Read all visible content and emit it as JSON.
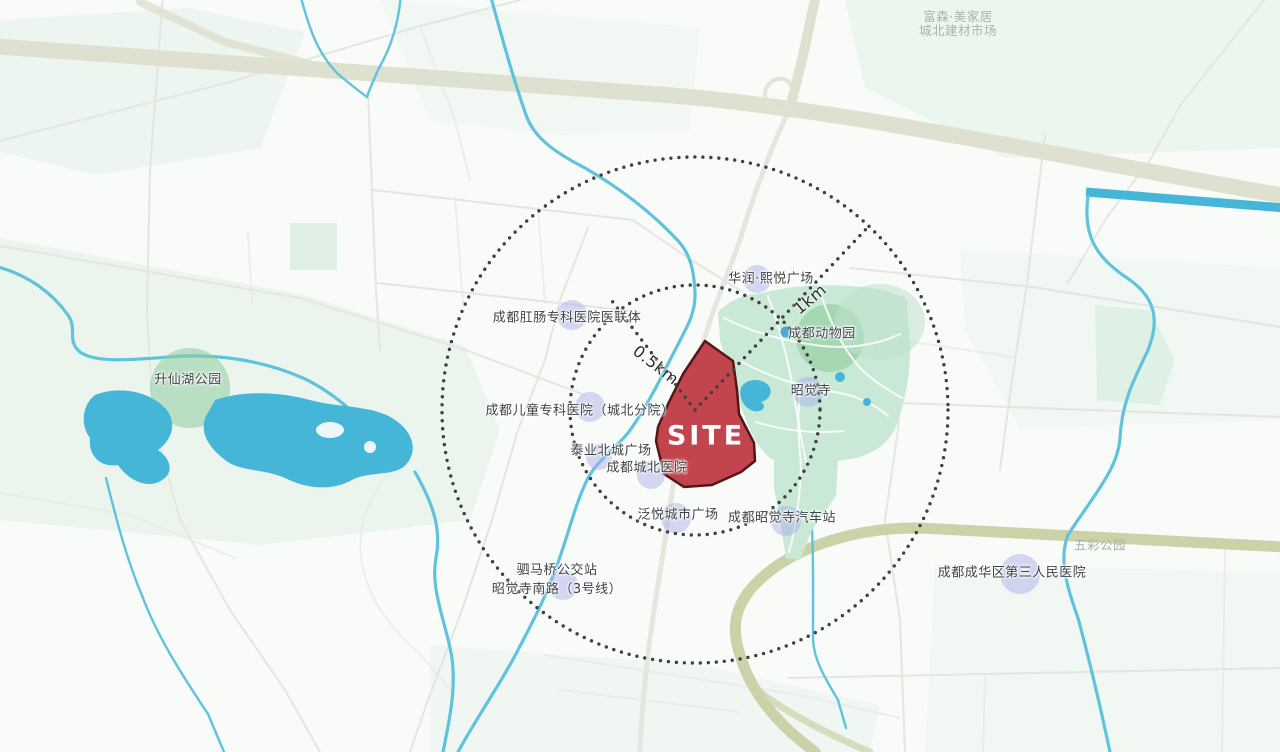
{
  "site": {
    "label": "SITE"
  },
  "rings": {
    "inner_label": "0.5km",
    "outer_label": "1km"
  },
  "places": [
    {
      "id": "fusen-market",
      "line1": "富森·美家居",
      "line2": "城北建材市场"
    },
    {
      "id": "anorectal-hospital",
      "label": "成都肛肠专科医院医联体"
    },
    {
      "id": "cr-xiyue-plaza",
      "label": "华润·熙悦广场"
    },
    {
      "id": "chengdu-zoo",
      "label": "成都动物园"
    },
    {
      "id": "zhaojue-temple",
      "label": "昭觉寺"
    },
    {
      "id": "shengxian-lake-park",
      "label": "升仙湖公园"
    },
    {
      "id": "children-hospital",
      "label": "成都儿童专科医院（城北分院）"
    },
    {
      "id": "taiye-beicheng-plaza",
      "label": "泰业北城广场"
    },
    {
      "id": "chengbei-hospital",
      "label": "成都城北医院"
    },
    {
      "id": "fanyue-city-plaza",
      "label": "泛悦城市广场"
    },
    {
      "id": "zhaojuesi-bus-station",
      "label": "成都昭觉寺汽车站"
    },
    {
      "id": "simaqiao-bus-stop",
      "line1": "驷马桥公交站",
      "line2": "昭觉寺南路（3号线）"
    },
    {
      "id": "chenghua-third-peoples-hospital",
      "label": "成都成华区第三人民医院"
    },
    {
      "id": "wucai-park",
      "label": "五彩公园"
    }
  ],
  "colors": {
    "site_fill": "#c2454d",
    "site_border": "#541619",
    "highlight_purple": "#a8ade8",
    "water": "#5fc3dd",
    "water_deep": "#45b6d8",
    "park_green": "#c9e9d6",
    "park_dark_green": "#9fd4ad",
    "park_circle": "#8fcc9e",
    "patch_green": "#e9f4ec",
    "patch_green_dark": "#ddeee3",
    "highway_top": "#dfe1d0",
    "highway_olive": "#cbd2a8",
    "road": "#e4e6df",
    "ring_dots": "#3f4040",
    "label_dark": "#3e4248",
    "label_muted": "#a7b5ab"
  }
}
